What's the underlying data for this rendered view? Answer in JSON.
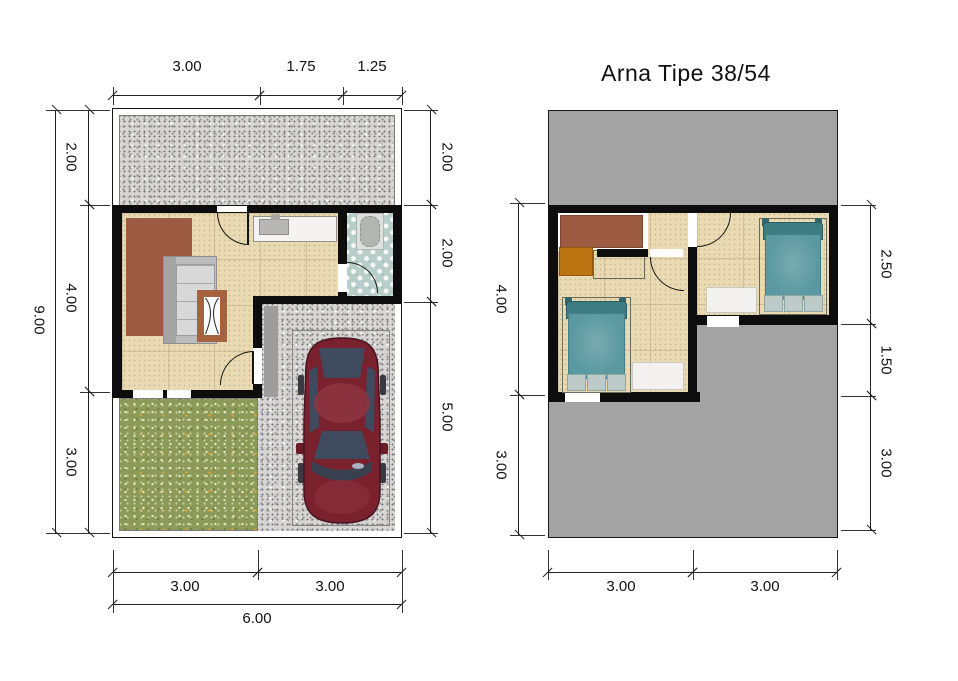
{
  "title": "Arna Tipe 38/54",
  "left_plan": {
    "name": "ground-floor-plan",
    "dims_top": [
      "3.00",
      "1.75",
      "1.25"
    ],
    "dims_left": [
      "2.00",
      "4.00",
      "3.00"
    ],
    "total_left": "9.00",
    "dims_right": [
      "2.00",
      "2.00",
      "5.00"
    ],
    "dims_bottom": [
      "3.00",
      "3.00"
    ],
    "total_bottom": "6.00"
  },
  "right_plan": {
    "name": "upper-floor-plan",
    "dims_left": [
      "4.00",
      "3.00"
    ],
    "dims_right": [
      "2.50",
      "1.50",
      "3.00"
    ],
    "dims_bottom": [
      "3.00",
      "3.00"
    ]
  },
  "colors": {
    "wall": "#0d0d0d",
    "roof_gray": "#a3a3a3",
    "grass_green": "#8b9a58",
    "floor_tile": "#e9dab3",
    "bath_tile": "#b7cec9",
    "rug_brown": "#9c5a40",
    "desk_orange": "#bd7413",
    "bed_teal": "#5b99a0",
    "car_red": "#7a212e"
  }
}
